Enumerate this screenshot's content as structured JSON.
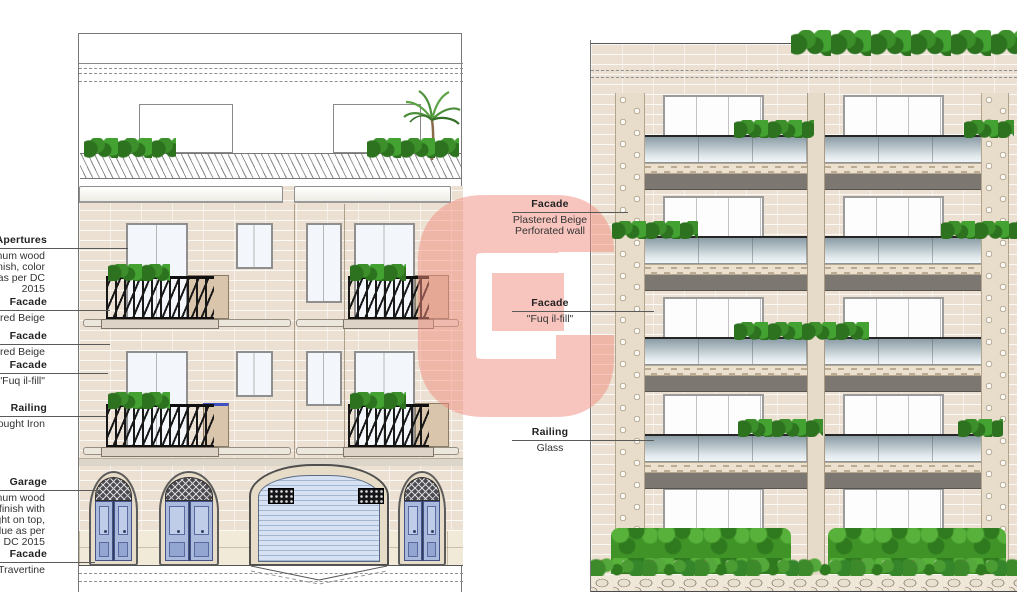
{
  "drawing": {
    "kind": "architectural elevations",
    "left_elevation": {
      "upper_floors": 2,
      "entrance_doors": 3,
      "garage_doors": 1,
      "roof_terrace": true
    },
    "right_elevation": {
      "floors": 5,
      "bays": 2,
      "glass_balustrades": true
    }
  },
  "annotations": {
    "left": [
      {
        "label": "Apertures",
        "lines": [
          "ninum wood",
          "finish, color",
          "e as per DC",
          "2015"
        ]
      },
      {
        "label": "Facade",
        "lines": [
          "tered Beige"
        ]
      },
      {
        "label": "Facade",
        "lines": [
          "tered Beige"
        ]
      },
      {
        "label": "Facade",
        "lines": [
          "\"Fuq il-fill\""
        ]
      },
      {
        "label": "Railing",
        "lines": [
          "Wrought Iron"
        ]
      },
      {
        "label": "Garage",
        "lines": [
          "ninum wood",
          "e finish with",
          "light on top,",
          "Blue as per",
          "DC 2015"
        ]
      },
      {
        "label": "Facade",
        "lines": [
          "Travertine"
        ]
      }
    ],
    "middle": [
      {
        "label": "Facade",
        "lines": [
          "Plastered Beige",
          "Perforated wall"
        ]
      },
      {
        "label": "Facade",
        "lines": [
          "\"Fuq il-fill\""
        ]
      },
      {
        "label": "Railing",
        "lines": [
          "Glass"
        ]
      }
    ]
  },
  "watermark": {
    "letter": "G",
    "color": "rgba(242,140,125,0.5)"
  },
  "colors": {
    "facade_beige": "#EBE0D1",
    "travertine": "#F2EAD9",
    "door_blue": "#A9BADD",
    "garage_shutter_blue": "#D6E2F3",
    "glass_balustrade_gray": "#8C9DA6",
    "slab_gray": "#7D7771",
    "hedge_green": "#3F9327",
    "wrought_iron_black": "#181818",
    "watermark_pink": "#F28C7D"
  }
}
